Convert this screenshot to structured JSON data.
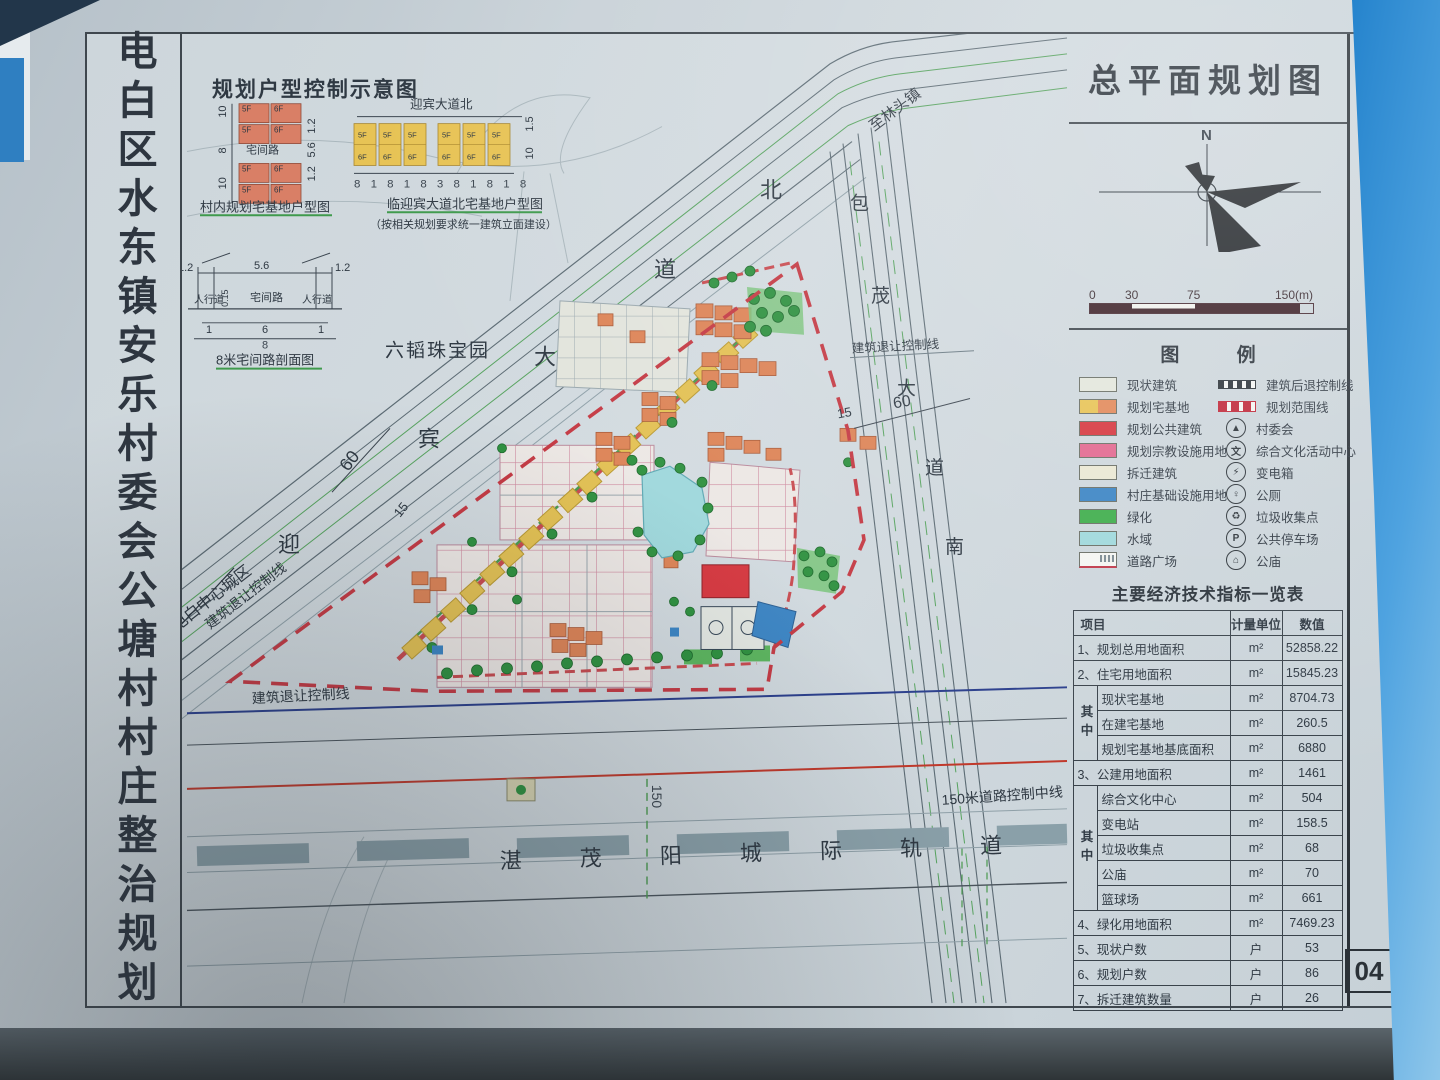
{
  "board": {
    "side_title": "电白区水东镇安乐村委会公塘村村庄整治规划",
    "page_number": "04"
  },
  "colors": {
    "boundary_red": "#c43a44",
    "setback_blue": "#2b3f8c",
    "control_red": "#c0392b",
    "green": "#3fae4c",
    "water": "#9fd8dc",
    "homestead_yellow": "#e3c154",
    "existing_orange": "#dd8457",
    "public_red": "#d6373f"
  },
  "insets": {
    "title": "规划户型控制示意图",
    "floors": [
      "5F",
      "6F"
    ],
    "left": {
      "road_label": "宅间路",
      "dims_left": [
        "10",
        "8",
        "10"
      ],
      "dims_right": [
        "1.2",
        "5.6",
        "1.2"
      ],
      "caption": "村内规划宅基地户型图"
    },
    "right": {
      "top_label": "迎宾大道北",
      "dims_bottom": "8 1 8 1 8 3 8 1 8 1 8",
      "dims_right": [
        "1.5",
        "10"
      ],
      "caption": "临迎宾大道北宅基地户型图",
      "note": "（按相关规划要求统一建筑立面建设）"
    },
    "section": {
      "dims_top": [
        "1.2",
        "5.6",
        "1.2"
      ],
      "labels": [
        "人行道",
        "宅间路",
        "人行道"
      ],
      "dim_small": "0.15",
      "dims_bottom": [
        "1",
        "6",
        "1"
      ],
      "dim_total": "8",
      "caption": "8米宅间路剖面图"
    }
  },
  "map_labels": {
    "jewelry_park": "六韬珠宝园",
    "to_lintou": "至林头镇",
    "to_dianbai": "至电白中心城区",
    "yingbin_chars": [
      "迎",
      "宾",
      "大",
      "道",
      "北"
    ],
    "baomao_chars": [
      "包",
      "茂",
      "大",
      "道",
      "南"
    ],
    "setback_line": "建筑退让控制线",
    "dim_60": "60",
    "dim_15": "15",
    "dim_150": "150",
    "rail": "湛 茂 阳 城 际 轨 道",
    "road_control": "150米道路控制中线"
  },
  "panel": {
    "title": "总平面规划图",
    "north": "N",
    "scale_ticks": [
      "0",
      "30",
      "75",
      "150(m)"
    ],
    "legend_title": "图  例",
    "legend_left": [
      {
        "label": "现状建筑",
        "color": "#e3e6dc",
        "color2": "#e3e6dc"
      },
      {
        "label": "规划宅基地",
        "color": "#e7c355",
        "color2": "#e2895a"
      },
      {
        "label": "规划公共建筑",
        "color": "#d6373f",
        "color2": "#d6373f"
      },
      {
        "label": "规划宗教设施用地",
        "color": "#e2688f",
        "color2": "#e2688f"
      },
      {
        "label": "拆迁建筑",
        "color": "#eae8d3",
        "color2": "#eae8d3"
      },
      {
        "label": "村庄基础设施用地",
        "color": "#3c85c4",
        "color2": "#3c85c4"
      },
      {
        "label": "绿化",
        "color": "#3fae4c",
        "color2": "#3fae4c"
      },
      {
        "label": "水域",
        "color": "#9fd8dc",
        "color2": "#9fd8dc"
      },
      {
        "label": "道路广场",
        "color": "#f4f5f2",
        "color2": "#f4f5f2"
      }
    ],
    "legend_right": [
      {
        "label": "建筑后退控制线",
        "type": "dash-black"
      },
      {
        "label": "规划范围线",
        "type": "dash-red"
      },
      {
        "label": "村委会",
        "glyph": "▲"
      },
      {
        "label": "综合文化活动中心",
        "glyph": "文"
      },
      {
        "label": "变电箱",
        "glyph": "⚡"
      },
      {
        "label": "公厕",
        "glyph": "♀"
      },
      {
        "label": "垃圾收集点",
        "glyph": "♻"
      },
      {
        "label": "公共停车场",
        "glyph": "P"
      },
      {
        "label": "公庙",
        "glyph": "⌂"
      }
    ],
    "table": {
      "title": "主要经济技术指标一览表",
      "headers": [
        "项目",
        "计量单位",
        "数值"
      ],
      "subgroup_label": "其中",
      "rows": [
        {
          "name": "1、规划总用地面积",
          "unit": "m²",
          "value": "52858.22"
        },
        {
          "name": "2、住宅用地面积",
          "unit": "m²",
          "value": "15845.23"
        },
        {
          "name": "现状宅基地",
          "unit": "m²",
          "value": "8704.73"
        },
        {
          "name": "在建宅基地",
          "unit": "m²",
          "value": "260.5"
        },
        {
          "name": "规划宅基地基底面积",
          "unit": "m²",
          "value": "6880"
        },
        {
          "name": "3、公建用地面积",
          "unit": "m²",
          "value": "1461"
        },
        {
          "name": "综合文化中心",
          "unit": "m²",
          "value": "504"
        },
        {
          "name": "变电站",
          "unit": "m²",
          "value": "158.5"
        },
        {
          "name": "垃圾收集点",
          "unit": "m²",
          "value": "68"
        },
        {
          "name": "公庙",
          "unit": "m²",
          "value": "70"
        },
        {
          "name": "篮球场",
          "unit": "m²",
          "value": "661"
        },
        {
          "name": "4、绿化用地面积",
          "unit": "m²",
          "value": "7469.23"
        },
        {
          "name": "5、现状户数",
          "unit": "户",
          "value": "53"
        },
        {
          "name": "6、规划户数",
          "unit": "户",
          "value": "86"
        },
        {
          "name": "7、拆迁建筑数量",
          "unit": "户",
          "value": "26"
        }
      ]
    }
  }
}
